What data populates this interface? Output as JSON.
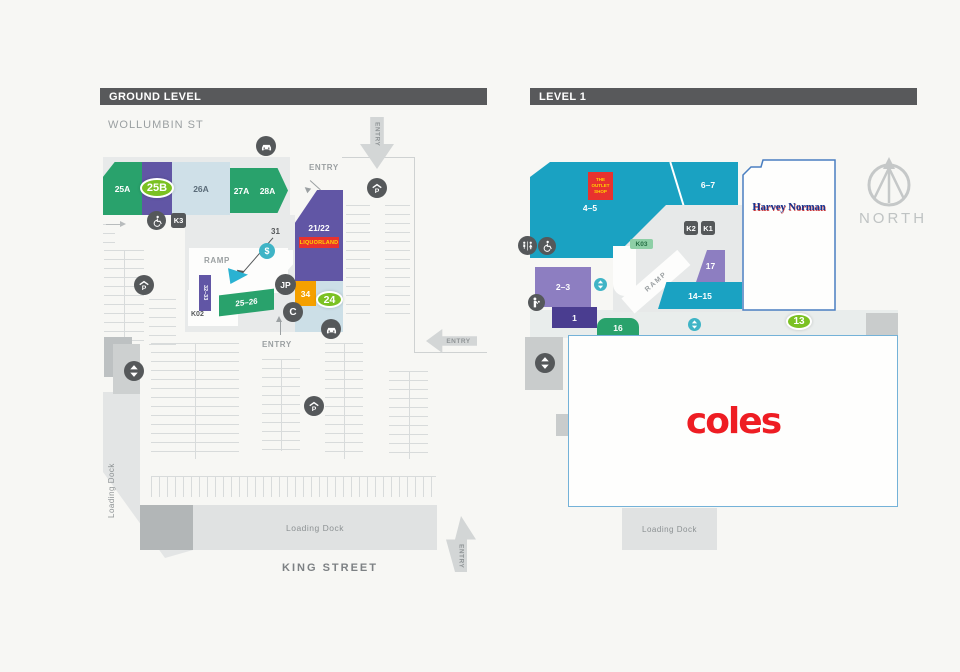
{
  "colors": {
    "header_bar": "#58595b",
    "green_shop": "#29a26c",
    "purple_shop": "#6156a5",
    "light_purple_shop": "#8d7ec1",
    "dark_purple_shop": "#4a3d90",
    "light_blue_shop": "#cfe0e8",
    "teal_shop": "#1aa2c2",
    "orange_shop": "#f5a000",
    "highlight_badge_green": "#7bc122",
    "promo_badge_red": "#e8322e",
    "promo_badge_text_yellow": "#ffd400",
    "icon_dark": "#55585a",
    "icon_teal": "#3fb4c6",
    "coles_red": "#ee1d23",
    "harvey_norman_blue": "#16338f",
    "muted_text": "#9ba0a2"
  },
  "icons": {
    "p": "P",
    "atm": "$",
    "jp": "JP",
    "c": "C"
  },
  "ground": {
    "title": "GROUND LEVEL",
    "street_top": "WOLLUMBIN ST",
    "street_bottom": "KING STREET",
    "entry": "ENTRY",
    "ramp": "RAMP",
    "loading_dock": "Loading Dock",
    "shops": {
      "s25a": "25A",
      "badge_25b": "25B",
      "s26a": "26A",
      "s27a": "27A",
      "s28a": "28A",
      "s2122": "21/22",
      "liquorland": "LIQUORLAND",
      "s31": "31",
      "s34": "34",
      "badge_24": "24",
      "s2526": "25–26",
      "s3233": "32–33",
      "k02": "K02",
      "k3": "K3"
    }
  },
  "level1": {
    "title": "LEVEL 1",
    "ramp": "RAMP",
    "loading_dock": "Loading Dock",
    "shops": {
      "s45": "4–5",
      "outlet": "THE OUTLET SHOP",
      "s67": "6–7",
      "harvey_norman": "Harvey Norman",
      "k2": "K2",
      "k1": "K1",
      "k03": "K03",
      "s17": "17",
      "s1415": "14–15",
      "s23": "2–3",
      "s1": "1",
      "s16": "16",
      "badge_13": "13",
      "coles": "coles"
    }
  },
  "compass": {
    "north": "NORTH"
  }
}
